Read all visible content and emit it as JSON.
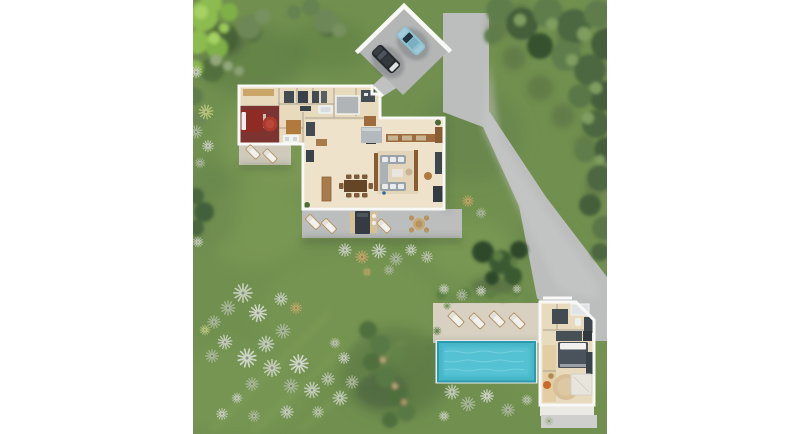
{
  "meta": {
    "description": "Photorealistic top-down aerial 3D site plan rendering of a villa property: main house floor plan with furniture, open carport with two cars, concrete driveway, landscaped lawn with olive trees and silver yucca shrubs, swimming pool with sun deck, and a guest house",
    "view": "top-down aerial render",
    "visible_text": ""
  },
  "colors": {
    "page_bg": "#ffffff",
    "grass": "#71904f",
    "grass_light": "#87a45c",
    "grass_dark": "#4e6a3c",
    "tree_bright": "#8cbb4f",
    "tree_bright_hi": "#a5d264",
    "tree_olive": "#5f7d4c",
    "tree_deep": "#445f3a",
    "tree_dark": "#36512f",
    "shrub_silver": "#c3cdbb",
    "shrub_sage": "#a9b79a",
    "shrub_dry": "#bfa469",
    "concrete": "#bcbebd",
    "concrete_dark": "#b4b6b6",
    "deck": "#d8d1c2",
    "deck_pale": "#ebe9e4",
    "wall": "#f8f8f6",
    "floor": "#e8dabd",
    "floor_light": "#eee2cb",
    "pool_water": "#45b7c9",
    "pool_deep": "#2e98ad",
    "bedroom_red": "#7d3330",
    "bed_red": "#8e2b24",
    "rug_red": "#aa3a2e",
    "rug_tan": "#d7bf97",
    "furniture_dark": "#3e464e",
    "sofa_gray": "#9aa3a9",
    "wood": "#9c6c3e",
    "wood_light": "#caa66a",
    "car_dark": "#26292d",
    "car_blue": "#8ec2d3",
    "lounger_white": "#f2f1ec",
    "pouf_orange": "#c96a2c"
  },
  "scene": {
    "carport": {
      "label": "open carport",
      "cars": [
        {
          "label": "dark gray car"
        },
        {
          "label": "light blue car"
        }
      ]
    },
    "driveway": {
      "label": "concrete driveway to street"
    },
    "main_house": {
      "label": "main house (roofless floor-plan view)",
      "rooms": [
        "master bedroom (red)",
        "master bathroom",
        "dressing closets",
        "office nook",
        "inner patio skylight",
        "kitchen",
        "dining area",
        "living room"
      ],
      "furniture": [
        "red double bed",
        "round red rug",
        "double vanity",
        "bathtub",
        "wardrobes",
        "kitchen island",
        "dining table with 8 chairs",
        "wood sideboard",
        "U-shaped gray sectional sofa",
        "coffee table",
        "media bench"
      ],
      "terrace_items": [
        "2 sun loungers",
        "outdoor kitchen with rug",
        "1 sun lounger",
        "round dining table with 4 chairs"
      ],
      "west_patio_items": [
        "2 wood sun loungers"
      ]
    },
    "pool_area": {
      "label": "swimming pool with sun deck",
      "sun_loungers": 4,
      "pool_shape": "rectangular"
    },
    "guest_house": {
      "label": "guest house (roofless floor-plan view)",
      "rooms": [
        "bathroom",
        "wardrobe hall",
        "bedroom",
        "lounge"
      ],
      "furniture": [
        "shower",
        "dark vanity",
        "wardrobes",
        "double bed with white pillows",
        "round tan rug",
        "white daybed",
        "orange pouf"
      ]
    },
    "landscape": {
      "lawn": "mowed green lawn",
      "vegetation": [
        "bright green trees northwest",
        "olive tree masses north and east",
        "dark pine cluster above pool",
        "silver yucca/palm shrub field southwest",
        "shrub rows between house and pool"
      ]
    }
  }
}
